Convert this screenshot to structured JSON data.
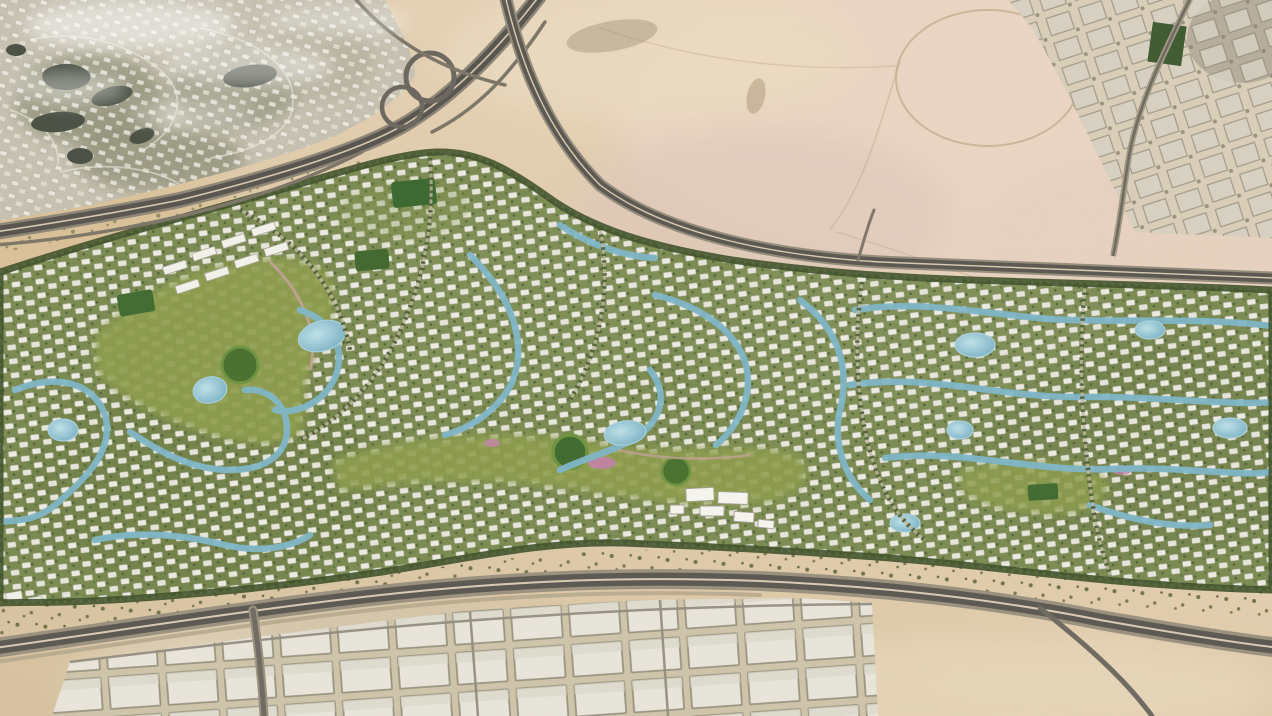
{
  "scene": {
    "title": "Aerial masterplan render of a desert residential mega-community",
    "description": "Satellite-style aerial view: an elongated green master-planned villa community with lagoons, waterways, parks and tree-lined roads, surrounded by open desert. An existing golf community with dark lakes sits top-left beside a highway interchange; a development under construction occupies the top-right corner; highways border the community on the north and south; a warehouse/industrial district lines the bottom edge.",
    "view_type": "aerial-satellite-composite"
  },
  "regions": [
    {
      "id": "masterplan-community",
      "label": "Master-planned villa community with lagoons and parks"
    },
    {
      "id": "existing-golf-community",
      "label": "Existing golf-course community (top left)"
    },
    {
      "id": "construction-district",
      "label": "District under construction (top right)"
    },
    {
      "id": "open-desert",
      "label": "Open desert land"
    },
    {
      "id": "industrial-district",
      "label": "Warehouse / industrial district (bottom)"
    }
  ],
  "roads": [
    {
      "id": "southwest-highway",
      "label": "Highway running southwest from the interchange"
    },
    {
      "id": "north-highway",
      "label": "Highway along the north edge of the community"
    },
    {
      "id": "south-highway",
      "label": "Highway along the south edge of the community"
    },
    {
      "id": "interchange",
      "label": "Multi-loop highway interchange"
    },
    {
      "id": "northeast-boundary-road",
      "label": "Boundary road of the construction district"
    }
  ],
  "water_features": [
    {
      "id": "community-lagoons",
      "label": "Swimmable turquoise lagoons and winding waterways"
    },
    {
      "id": "golf-lakes",
      "label": "Dark irrigation lakes in the golf community"
    }
  ],
  "landmarks": [
    {
      "id": "central-parks",
      "label": "Central park band with circular lawns and sports fields"
    },
    {
      "id": "desert-track-circle",
      "label": "Faint circular track in the open desert"
    },
    {
      "id": "cloud-wisps",
      "label": "Thin clouds over the golf community"
    }
  ],
  "palette": {
    "desert_base": "#dbc6a3",
    "desert_pink": "#ecd6c6",
    "community_green": "#7b8b51",
    "tree_green": "#3f512b",
    "park_green": "#8e9d4e",
    "lawn_green": "#48702e",
    "lagoon_blue": "#7fb6c8",
    "lagoon_light": "#b8dde6",
    "villa_white": "#f2f1ea",
    "asphalt": "#57544e",
    "golf_lake_dark": "#4a5044",
    "warehouse_roof": "#ebe8de"
  }
}
